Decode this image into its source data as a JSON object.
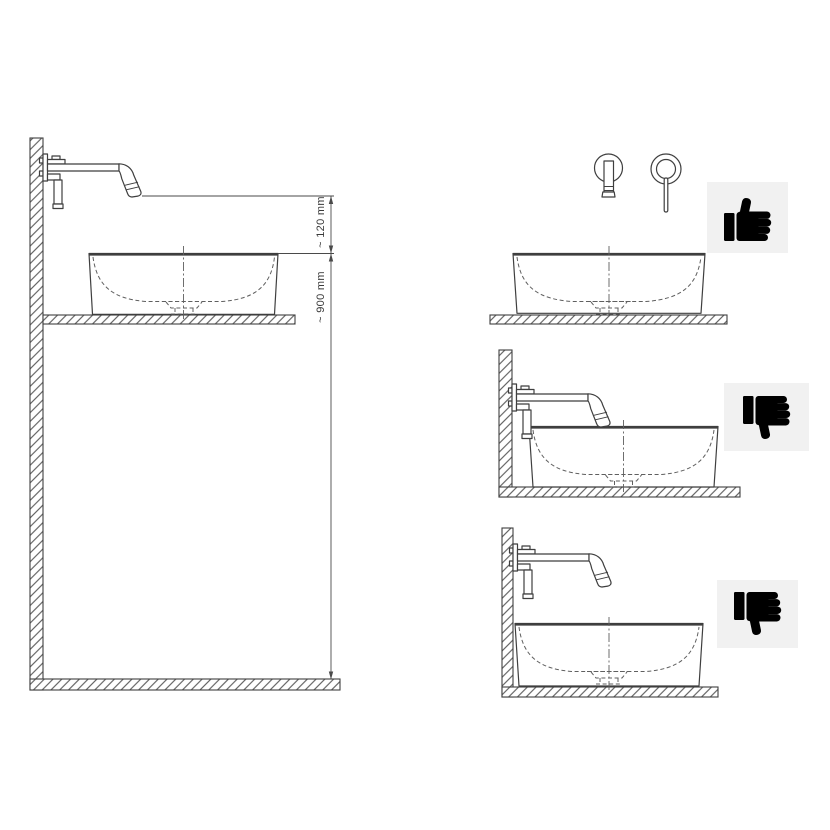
{
  "colors": {
    "background": "#ffffff",
    "line": "#3f3f3f",
    "dashed_line": "#5f5f5f",
    "dimension_line": "#4a4a4a",
    "label_text": "#3a3a3a",
    "badge_background": "#f1f1f1",
    "icon": "#000000"
  },
  "main_diagram": {
    "dimension_labels": {
      "spout_to_rim": "~ 120 mm",
      "rim_to_floor": "~ 900 mm"
    }
  },
  "panels": [
    {
      "position": "top-right",
      "verdict_icon": "thumbs-up-icon"
    },
    {
      "position": "middle-right",
      "verdict_icon": "thumbs-down-icon"
    },
    {
      "position": "bottom-right",
      "verdict_icon": "thumbs-down-icon"
    }
  ]
}
